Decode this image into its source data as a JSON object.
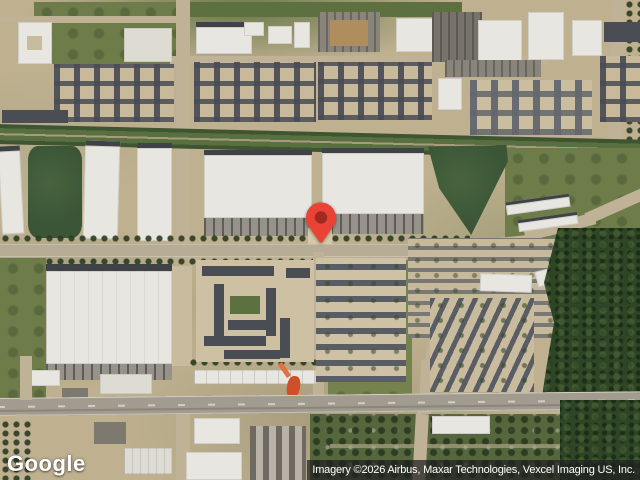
{
  "map": {
    "provider_logo": "Google",
    "attribution": "Imagery ©2026 Airbus, Maxar Technologies, Vexcel Imaging US, Inc.",
    "marker": {
      "color": "#EA4335",
      "dot_color": "#9E2A20"
    },
    "palette": {
      "grass": "#6e7c49",
      "dirt_tan": "#c2b392",
      "road": "#b7ad96",
      "warehouse_roof": "#e8e6e0",
      "apartment_roof": "#4a4e54",
      "forest": "#2f4627",
      "pond": "#3b5637",
      "attribution_bg": "rgba(32,32,32,0.72)"
    }
  }
}
